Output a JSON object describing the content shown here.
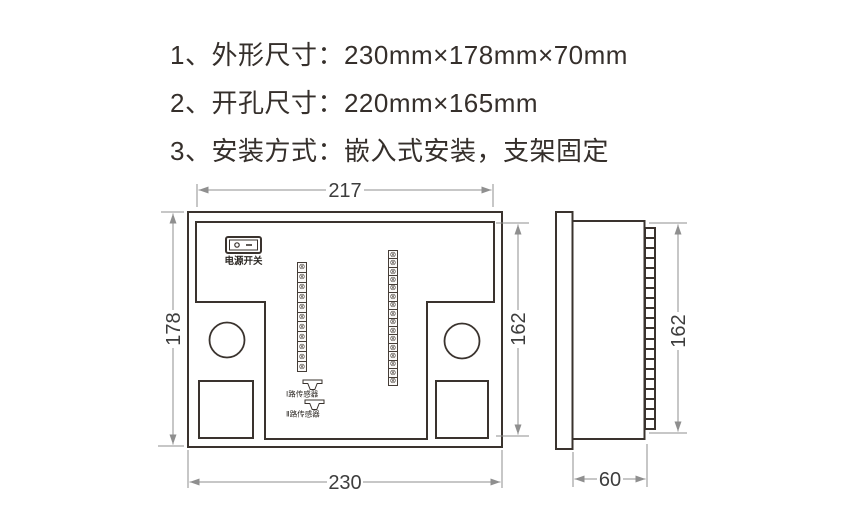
{
  "spec_list": {
    "lines": [
      "1、外形尺寸：230mm×178mm×70mm",
      "2、开孔尺寸：220mm×165mm",
      "3、安装方式：嵌入式安装，支架固定"
    ]
  },
  "rear_view": {
    "dim_width_top": "217",
    "dim_height_left": "178",
    "dim_height_right": "162",
    "dim_width_bottom": "230",
    "power_switch_label": "电源开关",
    "sensor_1_label": "Ⅰ路传感器",
    "sensor_2_label": "Ⅱ路传感器",
    "terminal_strip_left_count": 11,
    "terminal_strip_right_count": 16,
    "terminal_screw_glyph": "⊗"
  },
  "side_view": {
    "dim_height_right": "162",
    "dim_depth_bottom": "60",
    "terminal_block_count": 20
  },
  "colors": {
    "drawing_line": "#3a332e",
    "dimension_line": "#8f8f8f",
    "dimension_text": "#3d3d3d",
    "spec_text": "#352f2b",
    "background": "#ffffff"
  }
}
